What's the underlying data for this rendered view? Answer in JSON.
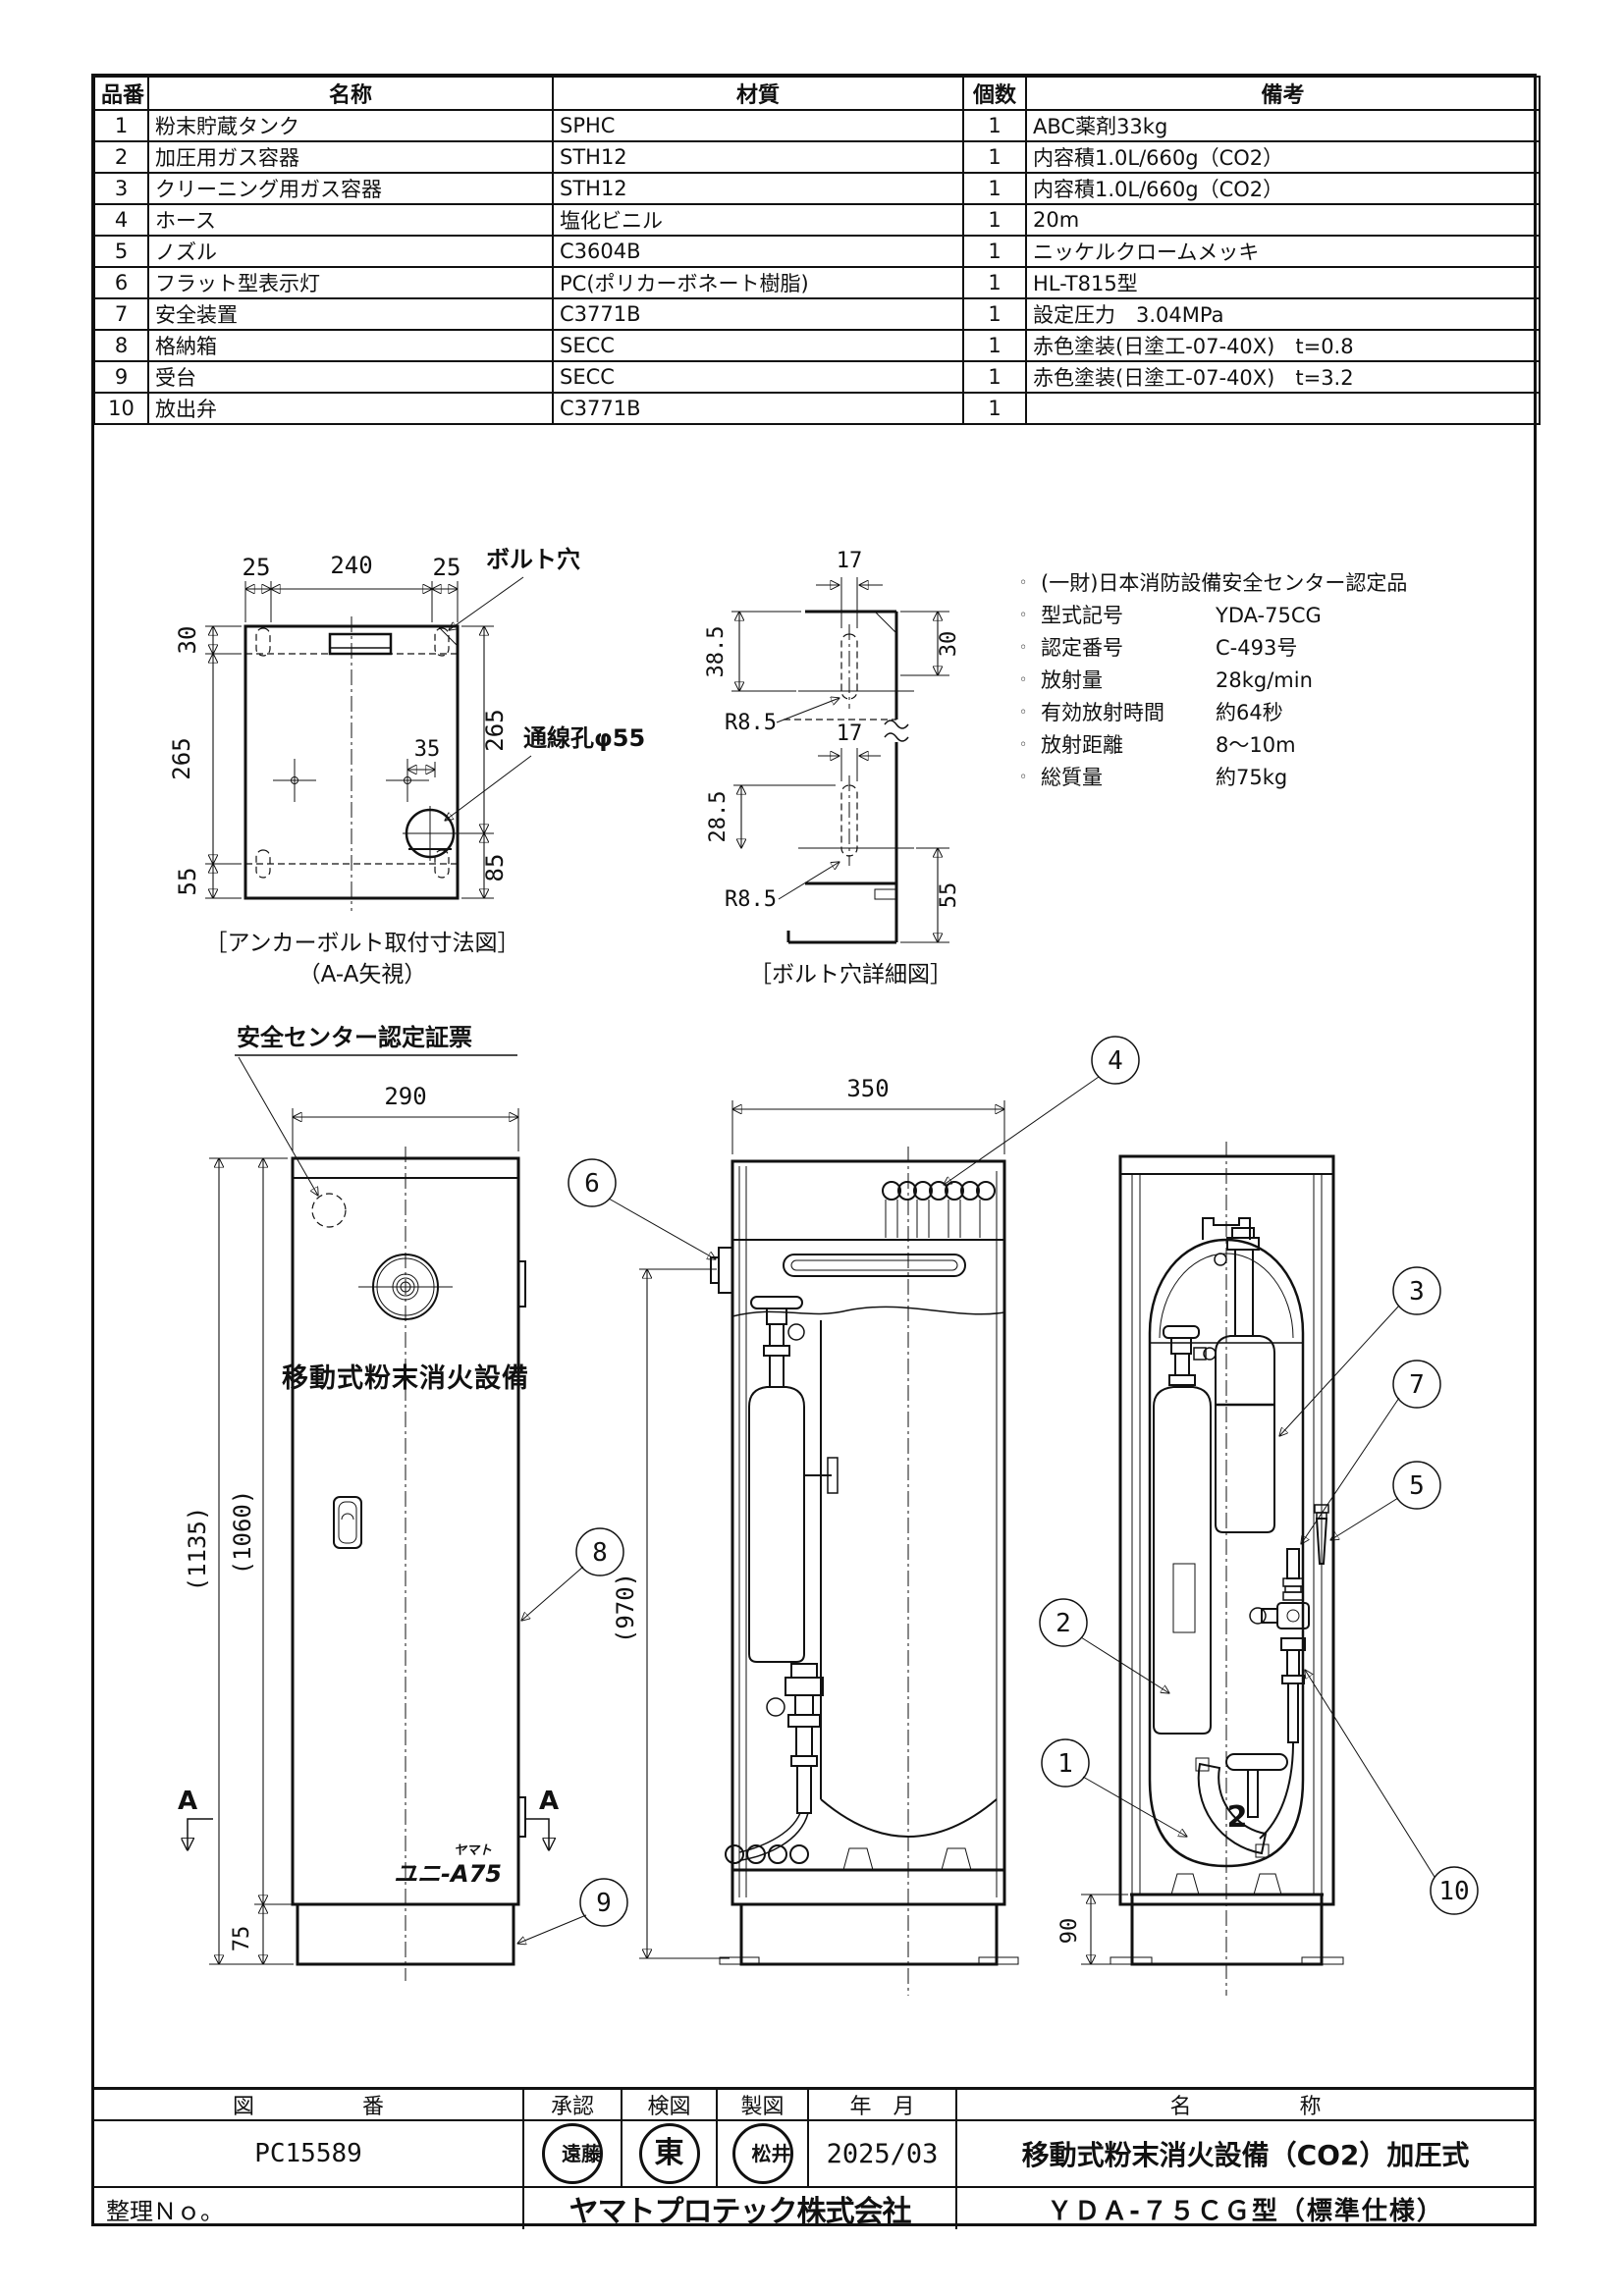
{
  "parts_table": {
    "headers": [
      "品番",
      "名称",
      "材質",
      "個数",
      "備考"
    ],
    "rows": [
      [
        "1",
        "粉末貯蔵タンク",
        "SPHC",
        "1",
        "ABC薬剤33kg"
      ],
      [
        "2",
        "加圧用ガス容器",
        "STH12",
        "1",
        "内容積1.0L/660g（CO2）"
      ],
      [
        "3",
        "クリーニング用ガス容器",
        "STH12",
        "1",
        "内容積1.0L/660g（CO2）"
      ],
      [
        "4",
        "ホース",
        "塩化ビニル",
        "1",
        "20m"
      ],
      [
        "5",
        "ノズル",
        "C3604B",
        "1",
        "ニッケルクロームメッキ"
      ],
      [
        "6",
        "フラット型表示灯",
        "PC(ポリカーボネート樹脂)",
        "1",
        "HL-T815型"
      ],
      [
        "7",
        "安全装置",
        "C3771B",
        "1",
        "設定圧力　3.04MPa"
      ],
      [
        "8",
        "格納箱",
        "SECC",
        "1",
        "赤色塗装(日塗工-07-40X)　t=0.8"
      ],
      [
        "9",
        "受台",
        "SECC",
        "1",
        "赤色塗装(日塗工-07-40X)　t=3.2"
      ],
      [
        "10",
        "放出弁",
        "C3771B",
        "1",
        ""
      ]
    ]
  },
  "anchor_fig": {
    "caption1": "［アンカーボルト取付寸法図］",
    "caption2": "（A-A矢視）",
    "labels": {
      "bolt_hole": "ボルト穴",
      "wire_hole": "通線孔φ55"
    },
    "dims": {
      "top_left": "25",
      "top_mid": "240",
      "top_right": "25",
      "left_top": "30",
      "left_mid": "265",
      "left_bottom": "55",
      "right_top": "265",
      "right_bottom": "85",
      "inner": "35"
    }
  },
  "bolt_fig": {
    "caption": "［ボルト穴詳細図］",
    "dims": {
      "t17a": "17",
      "t385": "38.5",
      "t30": "30",
      "r1": "R8.5",
      "t17b": "17",
      "t285": "28.5",
      "t55": "55",
      "r2": "R8.5"
    }
  },
  "specs": {
    "bullet": "◦",
    "items": [
      {
        "label": "(一財)日本消防設備安全センター認定品",
        "value": ""
      },
      {
        "label": "型式記号",
        "value": "YDA-75CG"
      },
      {
        "label": "認定番号",
        "value": "C-493号"
      },
      {
        "label": "放射量",
        "value": "28kg/min"
      },
      {
        "label": "有効放射時間",
        "value": "約64秒"
      },
      {
        "label": "放射距離",
        "value": "8～10m"
      },
      {
        "label": "総質量",
        "value": "約75kg"
      }
    ]
  },
  "views": {
    "front": {
      "cert_label": "安全センター認定証票",
      "panel_text": "移動式粉末消火設備",
      "logo_small": "ヤマト",
      "logo_main": "ユニ-A75",
      "section_mark": "A",
      "dims": {
        "w": "290",
        "h_total": "(1135)",
        "h_body": "(1060)",
        "base": "75"
      }
    },
    "side": {
      "dims": {
        "w": "350",
        "h": "(970)"
      }
    },
    "rear": {
      "dims": {
        "base": "90"
      },
      "nozzle_badge": "2"
    }
  },
  "callouts": {
    "c1": "1",
    "c2": "2",
    "c3": "3",
    "c4": "4",
    "c5": "5",
    "c6": "6",
    "c7": "7",
    "c8": "8",
    "c9": "9",
    "c10": "10"
  },
  "title_block": {
    "headers": {
      "zuban": "図　　　　　番",
      "approve": "承認",
      "check": "検図",
      "draft": "製図",
      "date": "年　月",
      "name": "名　　　　　称"
    },
    "sheet_no": "PC15589",
    "stamps": [
      "遠藤",
      "東",
      "松井"
    ],
    "date": "2025/03",
    "title": "移動式粉末消火設備（CO2）加圧式",
    "seiri_label": "整理Ｎｏ。",
    "company": "ヤマトプロテック株式会社",
    "model": "ＹＤＡ-７５ＣＧ型（標準仕様）"
  }
}
